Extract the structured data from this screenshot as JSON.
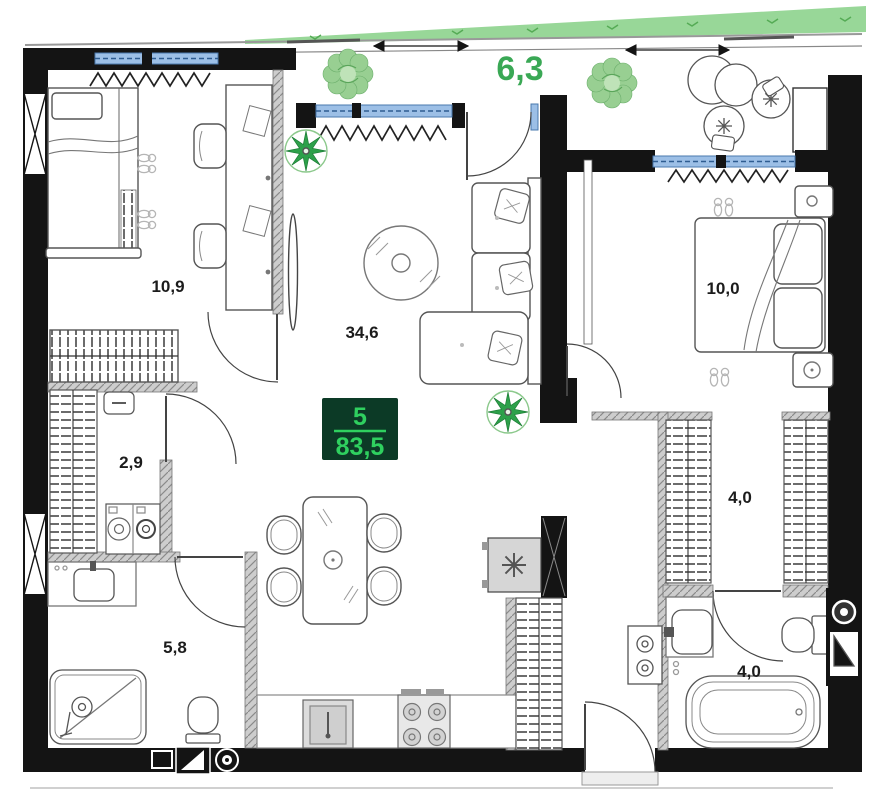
{
  "plan": {
    "unit_badge": {
      "unit_number": "5",
      "total_area": "83,5"
    },
    "balcony": {
      "area_label": "6,3"
    },
    "rooms": {
      "bedroom1": {
        "area_label": "10,9"
      },
      "living_kitchen": {
        "area_label": "34,6"
      },
      "closet": {
        "area_label": "2,9"
      },
      "bathroom1": {
        "area_label": "5,8"
      },
      "bedroom2": {
        "area_label": "10,0"
      },
      "wardrobe": {
        "area_label": "4,0"
      },
      "bathroom2": {
        "area_label": "4,0"
      }
    },
    "colors": {
      "wall": "#141414",
      "accent_green": "#3aa855",
      "balcony_band_green": "#98d798",
      "badge_bg": "#0c3a26",
      "badge_text": "#2fd05f",
      "window_blue": "#9cbfe6"
    }
  }
}
